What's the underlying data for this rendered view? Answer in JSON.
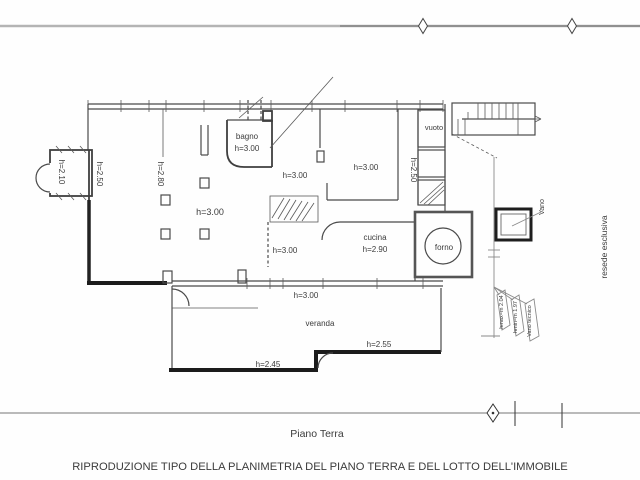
{
  "drawing": {
    "floor_title": "Piano Terra",
    "caption": "RIPRODUZIONE TIPO DELLA PLANIMETRIA DEL PIANO TERRA E DEL LOTTO DELL'IMMOBILE"
  },
  "labels": {
    "bagno_name": "bagno",
    "bagno_h": "h=3.00",
    "porch_h": "h=2.10",
    "aisle_left_h": "h=2.50",
    "aisle_mid_h": "h=2.80",
    "soggiorno_h": "h=3.00",
    "hall_upper_h": "h=3.00",
    "dining_h": "h=3.00",
    "shaft_h": "h=2.50",
    "vuoto_name": "vuoto",
    "hall_lower_h": "h=3.00",
    "cucina_name": "cucina",
    "cucina_h": "h=2.90",
    "forno_name": "forno",
    "veranda_top_h": "h=3.00",
    "veranda_name": "veranda",
    "veranda_right_h": "h=2.55",
    "veranda_left_h": "h=2.45",
    "vano_name": "Vano",
    "hmax": "hmax=m 2.04",
    "hmin": "hmin=m 1.97",
    "vano_tecnico": "Vano tecnico",
    "resede": "resede esclusiva"
  },
  "colors": {
    "wall": "#4a4a4a",
    "thick_wall": "#1c1c1c",
    "boundary_gray": "#b4b4b4",
    "text": "#3b3b3b"
  }
}
